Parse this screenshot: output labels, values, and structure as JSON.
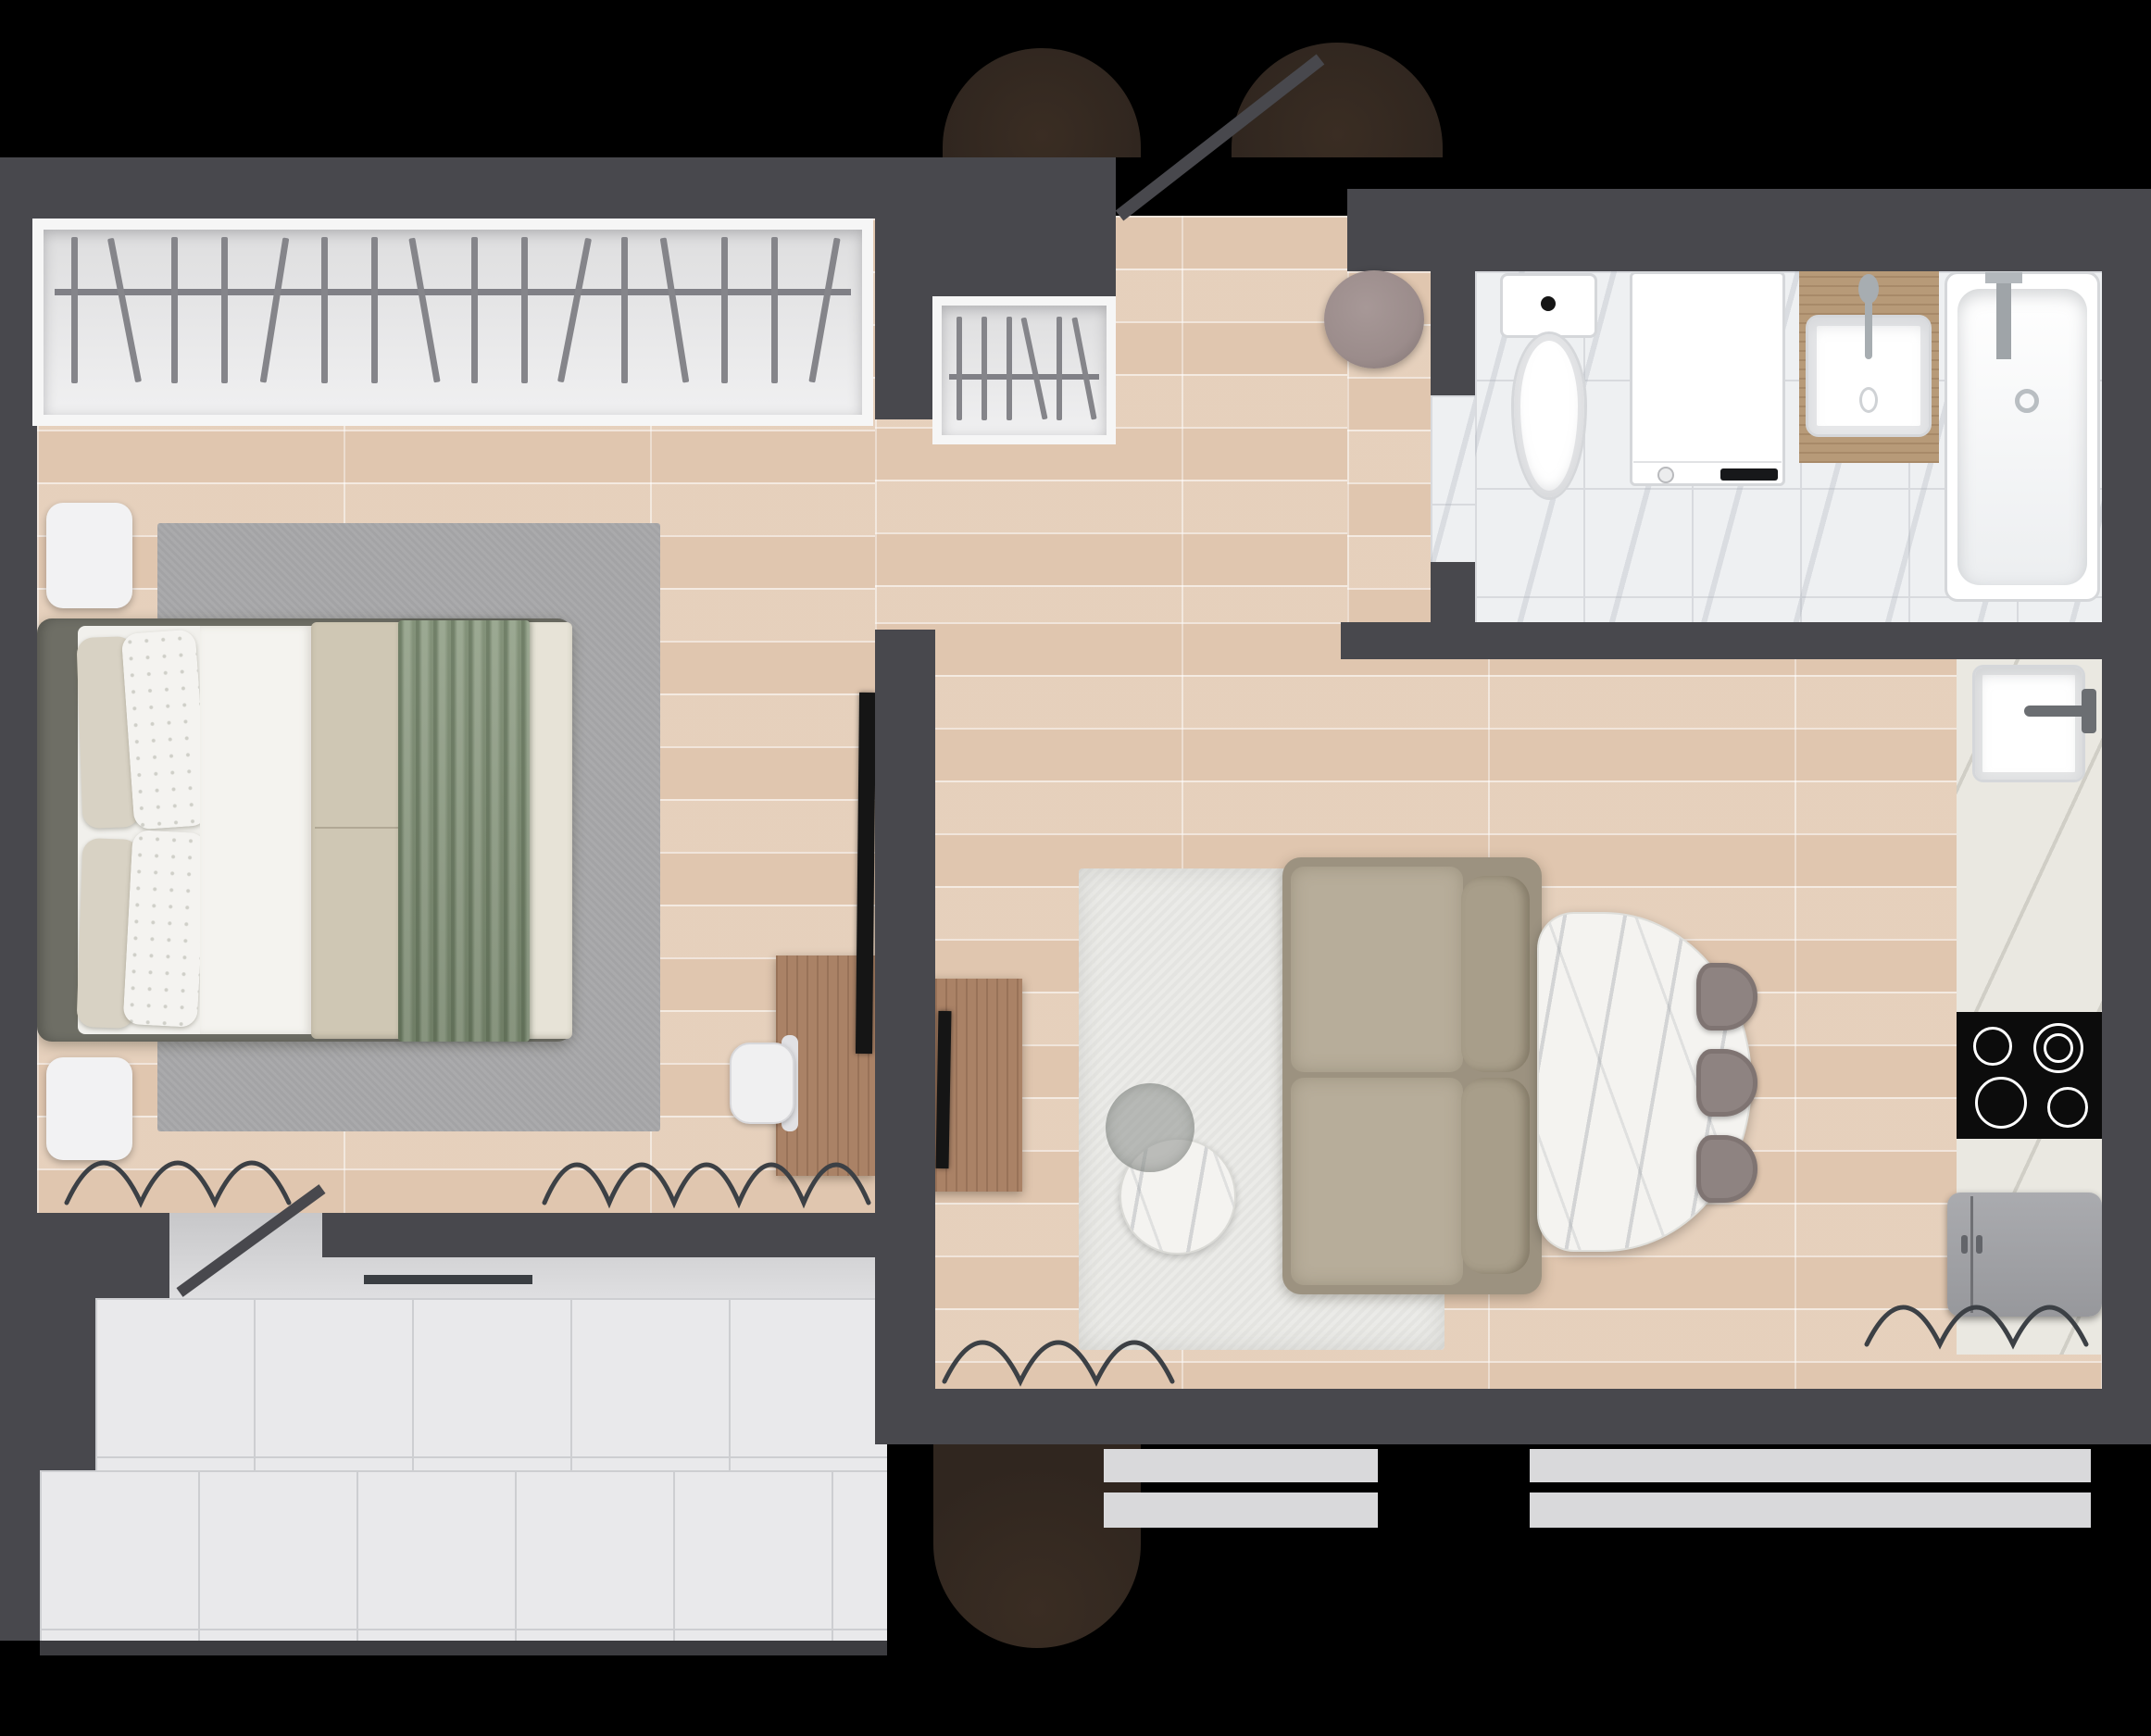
{
  "title": "Studio Apartment Floor Plan — Top-Down 3D Render",
  "palette": {
    "bg": "#000000",
    "wall": "#48484d",
    "wall_dark": "#3c3c40",
    "wood": "#e4ccb6",
    "marble": "#eef0f2",
    "marble_line": "#d8dade",
    "terrace": "#e9e9eb",
    "terrace_line": "#cdced1",
    "balcony_a": "#c7c7c9",
    "balcony_b": "#dfdfe1",
    "glass": "#d9d9db",
    "tree": "#30261f",
    "rug_gray": "#a6a6a8",
    "rug_white": "#eaeae7",
    "bed_frame": "#6e6e65",
    "mattress": "#f1f0ec",
    "pillow_beige": "#d8d2c4",
    "pillow_white": "#f4f3f0",
    "sheet": "#f4f3ef",
    "duvet": "#cfc7b4",
    "duvet_fold": "#e7e3d7",
    "blanket": "#87977c",
    "nightstand": "#f2f2f3",
    "wood_furn": "#aa8266",
    "tv": "#151515",
    "sofa_base": "#9c9280",
    "sofa_seat": "#b7ad9a",
    "sofa_back": "#a89e8a",
    "table_marble": "#f4f3f0",
    "chair": "#8e8381",
    "counter": "#eae8e1",
    "fixture": "#ffffff",
    "fixture_line": "#d5d7da",
    "vanity": "#b79a78",
    "fridge_a": "#97989c",
    "fridge_b": "#aaabaf",
    "cooktop": "#0c0c0c",
    "burner": "#ffffff",
    "radiator": "#3c4045",
    "hanger": "#85858a",
    "rail": "#808086",
    "closet_frame": "#f6f6f6",
    "closet_int_a": "#dededf",
    "closet_int_b": "#f0f0f1",
    "pouf": "#9b8c8b",
    "line_dark": "#3a3e42"
  },
  "rooms": {
    "bedroom": {
      "label": "Bedroom",
      "items": [
        "wardrobe",
        "double-bed",
        "nightstand-top",
        "nightstand-bottom",
        "gray-area-rug",
        "desk",
        "office-chair",
        "wall-tv",
        "radiator",
        "balcony-door"
      ]
    },
    "hallway": {
      "label": "Entry Hall",
      "items": [
        "entry-closet",
        "round-pouf",
        "entrance-door"
      ]
    },
    "bathroom": {
      "label": "Bathroom",
      "items": [
        "toilet",
        "washing-machine",
        "vanity-sink",
        "bathtub"
      ]
    },
    "kitchen": {
      "label": "Kitchen",
      "items": [
        "stone-counter",
        "kitchen-sink",
        "cooktop",
        "refrigerator",
        "radiator"
      ]
    },
    "living_room": {
      "label": "Living Room",
      "items": [
        "white-area-rug",
        "two-seat-sofa",
        "coffee-table-marble",
        "coffee-table-glass",
        "oval-dining-table",
        "dining-chair",
        "dining-chair",
        "dining-chair",
        "tv-console",
        "tv",
        "radiator"
      ]
    },
    "balcony": {
      "label": "Balcony Terrace",
      "items": [
        "tile-floor",
        "glazing-line",
        "door-swing"
      ]
    }
  },
  "closets": {
    "wardrobe": {
      "count": 16,
      "tilts": [
        0,
        -11,
        0,
        0,
        9,
        0,
        0,
        -10,
        0,
        0,
        11,
        0,
        -9,
        0,
        0,
        10
      ]
    },
    "entry": {
      "count": 6,
      "tilts": [
        0,
        0,
        0,
        -12,
        0,
        -11
      ]
    }
  },
  "counts": {
    "dining_chairs": 3,
    "cooktop_burners": 4,
    "radiators": 4,
    "windows": 2,
    "trees": 3,
    "nightstands": 2
  }
}
